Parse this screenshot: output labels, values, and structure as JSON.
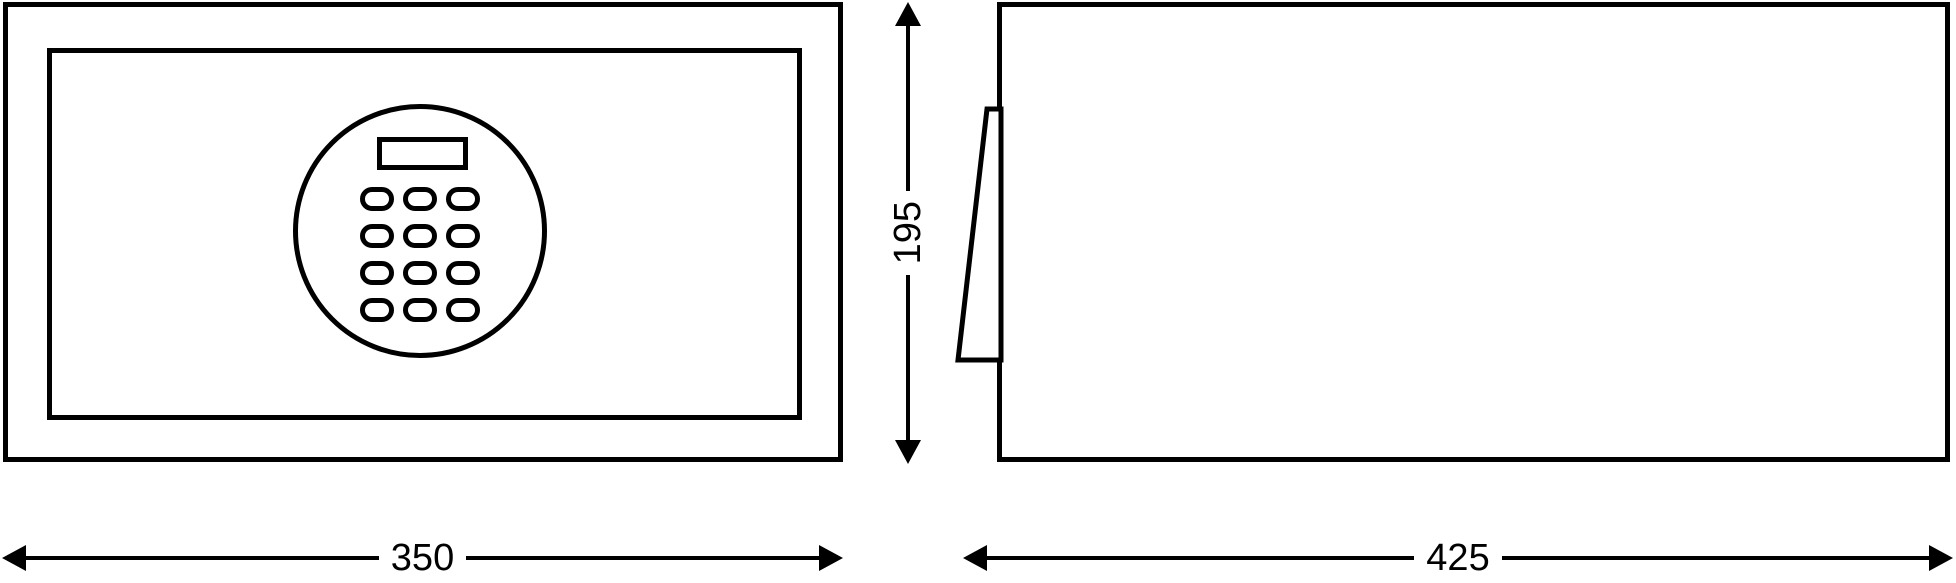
{
  "colors": {
    "background": "#ffffff",
    "line": "#000000"
  },
  "dimensions": {
    "width": "350",
    "height": "195",
    "depth": "425"
  },
  "keypad": {
    "rows": 4,
    "cols": 3
  }
}
